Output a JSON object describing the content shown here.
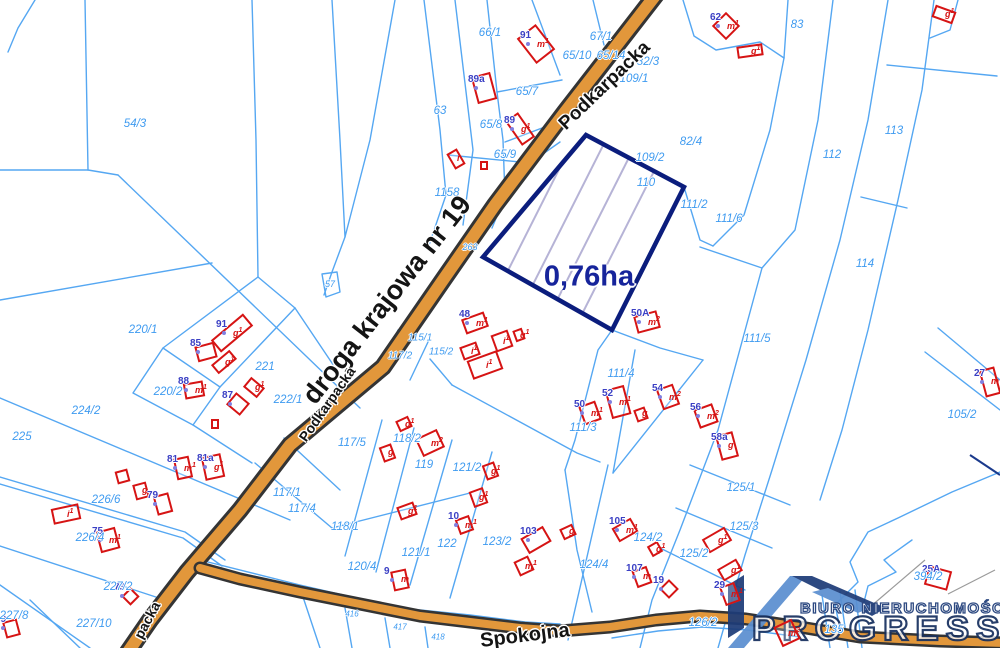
{
  "map": {
    "highlight": {
      "area_label": "0,76ha",
      "x": 589,
      "y": 277
    },
    "colors": {
      "parcel_line": "#55a7f2",
      "parcel_text": "#3f9bf0",
      "road_fill": "#e2973b",
      "road_casing": "#343434",
      "building": "#d61414",
      "building_number": "#3a3fc4",
      "highlight_border": "#0b1d7d",
      "highlight_label": "#16249b"
    },
    "streets": [
      {
        "name": "Podkarpacka",
        "x": 605,
        "y": 86,
        "rot": -44,
        "size": 19
      },
      {
        "name": "droga krajowa nr 19",
        "x": 387,
        "y": 300,
        "rot": -52,
        "size": 27
      },
      {
        "name": "Podkarpacka",
        "x": 327,
        "y": 404,
        "rot": -55,
        "size": 14
      },
      {
        "name": "packa",
        "x": 147,
        "y": 620,
        "rot": -62,
        "size": 14
      },
      {
        "name": "Spokojna",
        "x": 525,
        "y": 636,
        "rot": -7,
        "size": 20
      }
    ],
    "parcels": [
      {
        "label": "54/3",
        "x": 135,
        "y": 124
      },
      {
        "label": "66/1",
        "x": 490,
        "y": 33
      },
      {
        "label": "65/10",
        "x": 577,
        "y": 56
      },
      {
        "label": "67/1",
        "x": 601,
        "y": 37
      },
      {
        "label": "65/14",
        "x": 611,
        "y": 56
      },
      {
        "label": "63",
        "x": 440,
        "y": 111
      },
      {
        "label": "65/7",
        "x": 527,
        "y": 92
      },
      {
        "label": "65/8",
        "x": 491,
        "y": 125
      },
      {
        "label": "65/9",
        "x": 505,
        "y": 155
      },
      {
        "label": "1158",
        "x": 447,
        "y": 193
      },
      {
        "label": "82/3",
        "x": 648,
        "y": 62
      },
      {
        "label": "109/1",
        "x": 634,
        "y": 79
      },
      {
        "label": "83",
        "x": 797,
        "y": 25
      },
      {
        "label": "82/4",
        "x": 691,
        "y": 142
      },
      {
        "label": "109/2",
        "x": 650,
        "y": 158
      },
      {
        "label": "110",
        "x": 646,
        "y": 183
      },
      {
        "label": "111/2",
        "x": 694,
        "y": 205
      },
      {
        "label": "111/6",
        "x": 729,
        "y": 219
      },
      {
        "label": "112",
        "x": 832,
        "y": 155
      },
      {
        "label": "113",
        "x": 894,
        "y": 131
      },
      {
        "label": "114",
        "x": 865,
        "y": 264
      },
      {
        "label": "111/5",
        "x": 757,
        "y": 339
      },
      {
        "label": "105/2",
        "x": 962,
        "y": 415
      },
      {
        "label": "57",
        "x": 330,
        "y": 284,
        "size": 9
      },
      {
        "label": "263",
        "x": 470,
        "y": 247,
        "size": 9
      },
      {
        "label": "115/1",
        "x": 420,
        "y": 338,
        "size": 10
      },
      {
        "label": "115/2",
        "x": 441,
        "y": 352,
        "size": 10
      },
      {
        "label": "117/2",
        "x": 400,
        "y": 356,
        "size": 10
      },
      {
        "label": "220/1",
        "x": 143,
        "y": 330
      },
      {
        "label": "221",
        "x": 265,
        "y": 367
      },
      {
        "label": "220/2",
        "x": 168,
        "y": 392
      },
      {
        "label": "222/1",
        "x": 288,
        "y": 400
      },
      {
        "label": "224/2",
        "x": 86,
        "y": 411
      },
      {
        "label": "225",
        "x": 22,
        "y": 437
      },
      {
        "label": "117/1",
        "x": 287,
        "y": 493
      },
      {
        "label": "117/4",
        "x": 302,
        "y": 509
      },
      {
        "label": "226/6",
        "x": 106,
        "y": 500
      },
      {
        "label": "226/4",
        "x": 90,
        "y": 538
      },
      {
        "label": "227/2",
        "x": 118,
        "y": 587
      },
      {
        "label": "227/8",
        "x": 14,
        "y": 616
      },
      {
        "label": "227/10",
        "x": 94,
        "y": 624
      },
      {
        "label": "117/5",
        "x": 352,
        "y": 443
      },
      {
        "label": "118/2",
        "x": 407,
        "y": 439
      },
      {
        "label": "119",
        "x": 424,
        "y": 465
      },
      {
        "label": "121/2",
        "x": 467,
        "y": 468
      },
      {
        "label": "118/1",
        "x": 345,
        "y": 527
      },
      {
        "label": "122",
        "x": 447,
        "y": 544
      },
      {
        "label": "121/1",
        "x": 416,
        "y": 553
      },
      {
        "label": "120/4",
        "x": 362,
        "y": 567
      },
      {
        "label": "123/2",
        "x": 497,
        "y": 542
      },
      {
        "label": "111/3",
        "x": 583,
        "y": 428
      },
      {
        "label": "111/4",
        "x": 621,
        "y": 374
      },
      {
        "label": "124/4",
        "x": 594,
        "y": 565
      },
      {
        "label": "124/2",
        "x": 648,
        "y": 538
      },
      {
        "label": "125/1",
        "x": 741,
        "y": 488
      },
      {
        "label": "125/3",
        "x": 744,
        "y": 527
      },
      {
        "label": "125/2",
        "x": 694,
        "y": 554
      },
      {
        "label": "126/2",
        "x": 703,
        "y": 623
      },
      {
        "label": "394/2",
        "x": 928,
        "y": 577
      },
      {
        "label": "135",
        "x": 834,
        "y": 630
      },
      {
        "label": "416",
        "x": 352,
        "y": 614,
        "size": 8
      },
      {
        "label": "417",
        "x": 400,
        "y": 627,
        "size": 8
      },
      {
        "label": "418",
        "x": 438,
        "y": 637,
        "size": 8
      }
    ],
    "buildings": [
      {
        "x": 536,
        "y": 44,
        "w": 24,
        "h": 32,
        "rot": -38,
        "num": "91",
        "tag": "m1"
      },
      {
        "x": 484,
        "y": 88,
        "w": 20,
        "h": 28,
        "rot": -15,
        "num": "89a",
        "tag": ""
      },
      {
        "x": 520,
        "y": 129,
        "w": 16,
        "h": 30,
        "rot": -35,
        "num": "89",
        "tag": "g1"
      },
      {
        "x": 456,
        "y": 159,
        "w": 12,
        "h": 18,
        "rot": -30,
        "num": "",
        "tag": "i"
      },
      {
        "x": 484,
        "y": 165,
        "w": 8,
        "h": 9,
        "rot": 0,
        "num": "",
        "tag": ""
      },
      {
        "x": 726,
        "y": 26,
        "w": 20,
        "h": 20,
        "rot": 45,
        "num": "62",
        "tag": "m1"
      },
      {
        "x": 750,
        "y": 51,
        "w": 26,
        "h": 12,
        "rot": -8,
        "num": "",
        "tag": "g1"
      },
      {
        "x": 944,
        "y": 14,
        "w": 22,
        "h": 13,
        "rot": 20,
        "num": "",
        "tag": "g1"
      },
      {
        "x": 232,
        "y": 333,
        "w": 42,
        "h": 16,
        "rot": -40,
        "num": "91",
        "tag": "g1"
      },
      {
        "x": 224,
        "y": 362,
        "w": 24,
        "h": 12,
        "rot": -40,
        "num": "",
        "tag": "g1"
      },
      {
        "x": 206,
        "y": 352,
        "w": 20,
        "h": 16,
        "rot": -15,
        "num": "85",
        "tag": ""
      },
      {
        "x": 194,
        "y": 390,
        "w": 20,
        "h": 16,
        "rot": -10,
        "num": "88",
        "tag": "m1"
      },
      {
        "x": 238,
        "y": 404,
        "w": 18,
        "h": 16,
        "rot": 40,
        "num": "87",
        "tag": ""
      },
      {
        "x": 254,
        "y": 387,
        "w": 18,
        "h": 13,
        "rot": 40,
        "num": "",
        "tag": "g1"
      },
      {
        "x": 215,
        "y": 424,
        "w": 8,
        "h": 10,
        "rot": 0,
        "num": "",
        "tag": ""
      },
      {
        "x": 66,
        "y": 514,
        "w": 28,
        "h": 16,
        "rot": -12,
        "num": "",
        "tag": "i1"
      },
      {
        "x": 108,
        "y": 540,
        "w": 20,
        "h": 22,
        "rot": -15,
        "num": "75",
        "tag": "m1"
      },
      {
        "x": 122,
        "y": 476,
        "w": 13,
        "h": 13,
        "rot": -15,
        "num": "",
        "tag": ""
      },
      {
        "x": 141,
        "y": 491,
        "w": 14,
        "h": 16,
        "rot": -15,
        "num": "",
        "tag": "g"
      },
      {
        "x": 163,
        "y": 504,
        "w": 16,
        "h": 20,
        "rot": -15,
        "num": "79",
        "tag": ""
      },
      {
        "x": 183,
        "y": 468,
        "w": 16,
        "h": 22,
        "rot": -12,
        "num": "81",
        "tag": "m1"
      },
      {
        "x": 213,
        "y": 467,
        "w": 20,
        "h": 24,
        "rot": -12,
        "num": "81a",
        "tag": "g1"
      },
      {
        "x": 130,
        "y": 596,
        "w": 13,
        "h": 13,
        "rot": 45,
        "num": "73",
        "tag": ""
      },
      {
        "x": 11,
        "y": 628,
        "w": 15,
        "h": 17,
        "rot": -15,
        "num": "69",
        "tag": ""
      },
      {
        "x": 387,
        "y": 453,
        "w": 13,
        "h": 16,
        "rot": -20,
        "num": "",
        "tag": "g"
      },
      {
        "x": 404,
        "y": 424,
        "w": 14,
        "h": 12,
        "rot": -25,
        "num": "",
        "tag": "g1"
      },
      {
        "x": 430,
        "y": 443,
        "w": 24,
        "h": 20,
        "rot": -25,
        "num": "",
        "tag": "m2"
      },
      {
        "x": 490,
        "y": 471,
        "w": 13,
        "h": 16,
        "rot": -20,
        "num": "",
        "tag": "g1"
      },
      {
        "x": 478,
        "y": 497,
        "w": 15,
        "h": 17,
        "rot": -20,
        "num": "",
        "tag": "g1"
      },
      {
        "x": 464,
        "y": 525,
        "w": 15,
        "h": 16,
        "rot": -20,
        "num": "10",
        "tag": "m1"
      },
      {
        "x": 407,
        "y": 511,
        "w": 18,
        "h": 14,
        "rot": -20,
        "num": "",
        "tag": "g1"
      },
      {
        "x": 400,
        "y": 580,
        "w": 16,
        "h": 20,
        "rot": -12,
        "num": "9",
        "tag": "m"
      },
      {
        "x": 536,
        "y": 540,
        "w": 26,
        "h": 18,
        "rot": -30,
        "num": "103",
        "tag": ""
      },
      {
        "x": 524,
        "y": 566,
        "w": 16,
        "h": 16,
        "rot": -25,
        "num": "",
        "tag": "m1"
      },
      {
        "x": 568,
        "y": 532,
        "w": 14,
        "h": 12,
        "rot": -25,
        "num": "",
        "tag": "g"
      },
      {
        "x": 625,
        "y": 530,
        "w": 22,
        "h": 16,
        "rot": -30,
        "num": "105",
        "tag": "m1"
      },
      {
        "x": 655,
        "y": 549,
        "w": 12,
        "h": 12,
        "rot": -30,
        "num": "",
        "tag": "g1"
      },
      {
        "x": 642,
        "y": 577,
        "w": 16,
        "h": 18,
        "rot": -20,
        "num": "107",
        "tag": "m"
      },
      {
        "x": 717,
        "y": 540,
        "w": 26,
        "h": 16,
        "rot": -30,
        "num": "",
        "tag": "g1"
      },
      {
        "x": 730,
        "y": 570,
        "w": 22,
        "h": 14,
        "rot": -30,
        "num": "",
        "tag": "g1"
      },
      {
        "x": 730,
        "y": 594,
        "w": 16,
        "h": 20,
        "rot": -20,
        "num": "29",
        "tag": "m1"
      },
      {
        "x": 669,
        "y": 589,
        "w": 14,
        "h": 14,
        "rot": 45,
        "num": "19",
        "tag": ""
      },
      {
        "x": 787,
        "y": 633,
        "w": 20,
        "h": 22,
        "rot": -25,
        "num": "",
        "tag": "m2"
      },
      {
        "x": 938,
        "y": 578,
        "w": 24,
        "h": 20,
        "rot": 15,
        "num": "25A",
        "tag": ""
      },
      {
        "x": 590,
        "y": 413,
        "w": 18,
        "h": 20,
        "rot": -20,
        "num": "50",
        "tag": "m1"
      },
      {
        "x": 618,
        "y": 402,
        "w": 20,
        "h": 30,
        "rot": -15,
        "num": "52",
        "tag": "m1"
      },
      {
        "x": 641,
        "y": 414,
        "w": 12,
        "h": 13,
        "rot": -20,
        "num": "",
        "tag": "g"
      },
      {
        "x": 668,
        "y": 397,
        "w": 18,
        "h": 22,
        "rot": -20,
        "num": "54",
        "tag": "m2"
      },
      {
        "x": 706,
        "y": 416,
        "w": 20,
        "h": 20,
        "rot": -20,
        "num": "56",
        "tag": "m2"
      },
      {
        "x": 727,
        "y": 446,
        "w": 18,
        "h": 26,
        "rot": -15,
        "num": "58a",
        "tag": "g"
      },
      {
        "x": 990,
        "y": 382,
        "w": 16,
        "h": 28,
        "rot": -15,
        "num": "27",
        "tag": "m"
      },
      {
        "x": 475,
        "y": 323,
        "w": 24,
        "h": 16,
        "rot": -20,
        "num": "48",
        "tag": "m1"
      },
      {
        "x": 502,
        "y": 341,
        "w": 18,
        "h": 18,
        "rot": -20,
        "num": "",
        "tag": "i1"
      },
      {
        "x": 519,
        "y": 335,
        "w": 10,
        "h": 12,
        "rot": -20,
        "num": "",
        "tag": "g1"
      },
      {
        "x": 470,
        "y": 351,
        "w": 18,
        "h": 14,
        "rot": -20,
        "num": "",
        "tag": "i1"
      },
      {
        "x": 485,
        "y": 365,
        "w": 32,
        "h": 20,
        "rot": -20,
        "num": "",
        "tag": "i1"
      },
      {
        "x": 647,
        "y": 322,
        "w": 24,
        "h": 18,
        "rot": -15,
        "num": "50A",
        "tag": "m2"
      }
    ]
  },
  "logo": {
    "line1": "BIURO NIERUCHOMOŚCI",
    "line2": "PROGRESS"
  }
}
